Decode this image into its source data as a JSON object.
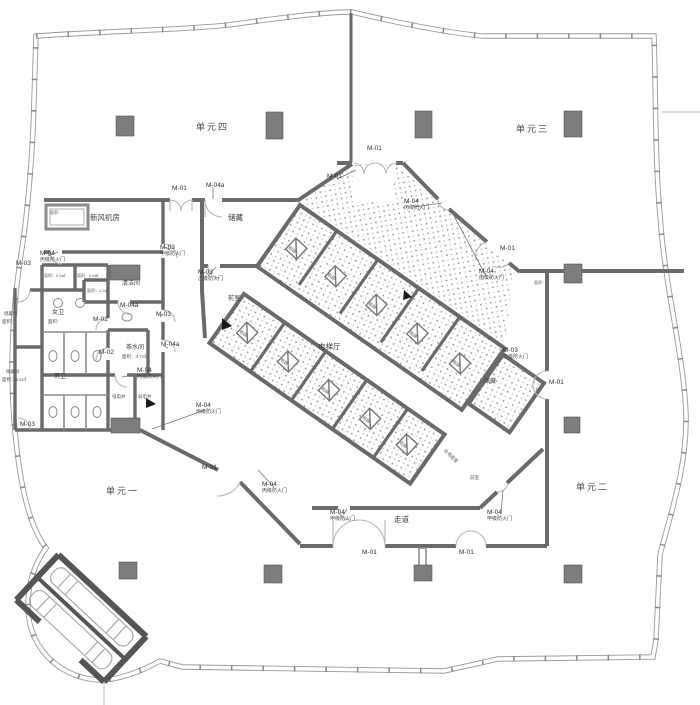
{
  "plan": {
    "units": {
      "u1": "单元一",
      "u2": "单元二",
      "u3": "单元三",
      "u4": "单元四"
    },
    "rooms": {
      "fresh_air": "新风机房",
      "storage_nw": "储藏",
      "cleaning": "清洁间",
      "female_wc": "女卫",
      "male_wc": "男卫",
      "tea": "茶水间",
      "storage_w1": "储藏间",
      "storage_w2": "储藏间",
      "elev_hall": "电梯厅",
      "vestibule_nw": "前室",
      "vestibule_s": "前室",
      "storage_e": "储藏",
      "corridor": "走道",
      "shared_vestibule": "合用前室",
      "strong_elec": "强电井",
      "weak_elec": "弱电井",
      "elevator": "电梯"
    },
    "areas": {
      "generic": "面积：",
      "tea": "面积：4.7㎡",
      "storage_w2": "面积：3.4㎡",
      "shaft1": "面积：0.5㎡",
      "shaft2": "面积：0.6㎡",
      "shaft3": "面积：1.2㎡"
    },
    "door_tags": {
      "m01": "M-01",
      "m02": "M-02",
      "m03": "M-03",
      "m04": "M-04",
      "m04a": "M-04a"
    },
    "door_types": {
      "jia": "甲级防火门",
      "yi": "乙级防火门",
      "bing": "丙级防火门"
    },
    "colors": {
      "wall": "#6a6a6a",
      "dark_wall": "#555555",
      "envelope": "#9a9a9a",
      "column": "#7d7d7d",
      "hatch_dot": "#8f8f8f",
      "door_arc": "#b5b5b5",
      "text": "#3c3c3c"
    }
  }
}
